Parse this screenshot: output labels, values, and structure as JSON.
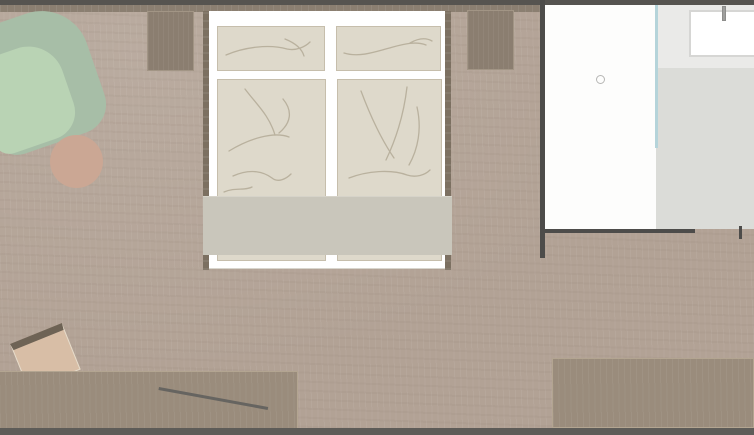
{
  "plan": {
    "type": "floor-plan",
    "view": "top-down",
    "visible_text": [],
    "rooms": [
      {
        "id": "bedroom",
        "label": "bedroom floor",
        "floor_color": "#b2a295"
      },
      {
        "id": "entry",
        "label": "door swing area",
        "floor_color": "#fdfdfc"
      },
      {
        "id": "bathroom",
        "label": "bathroom floor",
        "floor_color": "#dbdcd8"
      }
    ],
    "furniture": {
      "bed": {
        "label": "double bed with two pillows and two duvets"
      },
      "bench": {
        "label": "bench at foot of bed"
      },
      "nightstand_left": {
        "label": "left nightstand"
      },
      "nightstand_right": {
        "label": "right nightstand"
      },
      "armchair": {
        "label": "green armchair"
      },
      "side_table": {
        "label": "round side table"
      },
      "desk": {
        "label": "desk / sideboard bottom left"
      },
      "desk_chair": {
        "label": "desk chair"
      },
      "desk_object": {
        "label": "object on desk"
      },
      "sideboard": {
        "label": "sideboard bottom right"
      },
      "sink": {
        "label": "washbasin with faucet"
      },
      "ceiling_light": {
        "label": "ceiling light symbol"
      },
      "glass_partition": {
        "label": "glass partition"
      },
      "walls": {
        "label": "walls and door opening"
      }
    }
  },
  "colors": {
    "floor": "#b2a295",
    "wall-dark": "#565450",
    "wall-band": "#8b7f71",
    "wall-bottom": "#5e5c58",
    "wall-inner": "#4d4c4a",
    "white-area": "#fdfdfc",
    "bath-upper": "#eaeae8",
    "bath-lower": "#dbdcd8",
    "glass": "#b5d4da",
    "sink-border": "#d6d6d4",
    "faucet": "#9f9f9d",
    "light-ring": "#b6b6b4",
    "bed-frame": "#ffffff",
    "bedding": "#ded9cb",
    "bedding-border": "#c6beac",
    "bedding-line": "#b9b19e",
    "bench": "#c9c6bb",
    "rail": "#7c7061",
    "nightstand": "#8b7e70",
    "nightstand-border": "#a29585",
    "chair-shell": "#a7bea7",
    "chair-seat": "#b9d3b4",
    "table-round": "#cba794",
    "desk": "#9a8c7c",
    "desk-border": "#b3a591",
    "stool-seat": "#d8bea6",
    "stool-back": "#6e6355",
    "object-line": "#666460"
  }
}
